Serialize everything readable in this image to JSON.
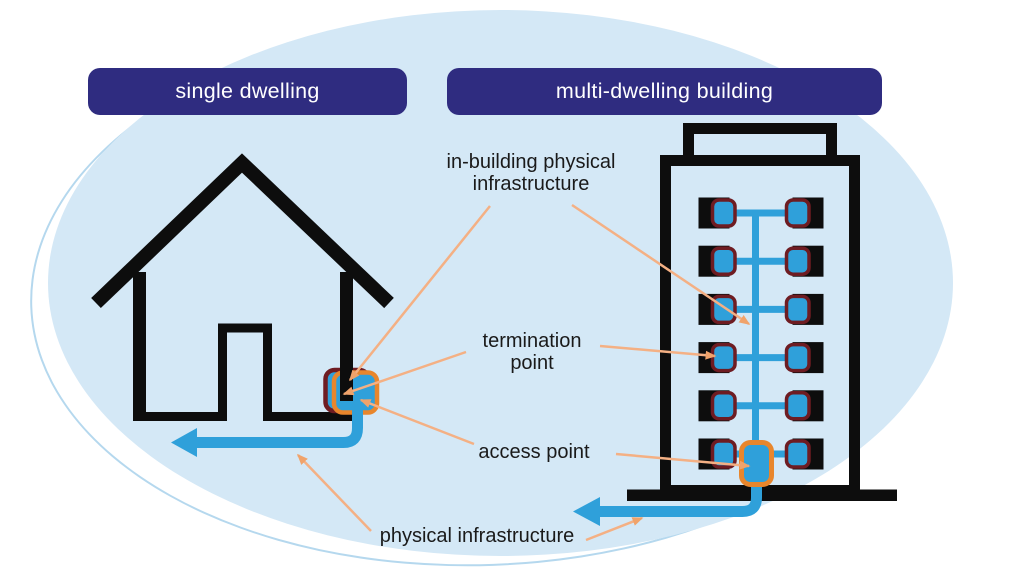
{
  "headers": {
    "single_dwelling": "single dwelling",
    "multi_dwelling": "multi-dwelling building"
  },
  "callouts": {
    "in_building": {
      "line1": "in-building physical",
      "line2": "infrastructure"
    },
    "termination": {
      "line1": "termination",
      "line2": "point"
    },
    "access": {
      "label": "access point"
    },
    "physical": {
      "label": "physical infrastructure"
    }
  },
  "diagram": {
    "building_floors": 6,
    "termination_points_per_floor": 2
  },
  "colors": {
    "background_ellipse": "#d4e8f6",
    "ellipse_outline": "#b5d8ee",
    "header_bg": "#2f2c80",
    "header_text": "#ffffff",
    "outline_black": "#0d0d0d",
    "cable_blue": "#2fa0da",
    "termination_point_border": "#6e1c22",
    "access_point_border": "#e8862c",
    "callout_arrow": "#f4b084",
    "label_text": "#1a1a1a"
  }
}
